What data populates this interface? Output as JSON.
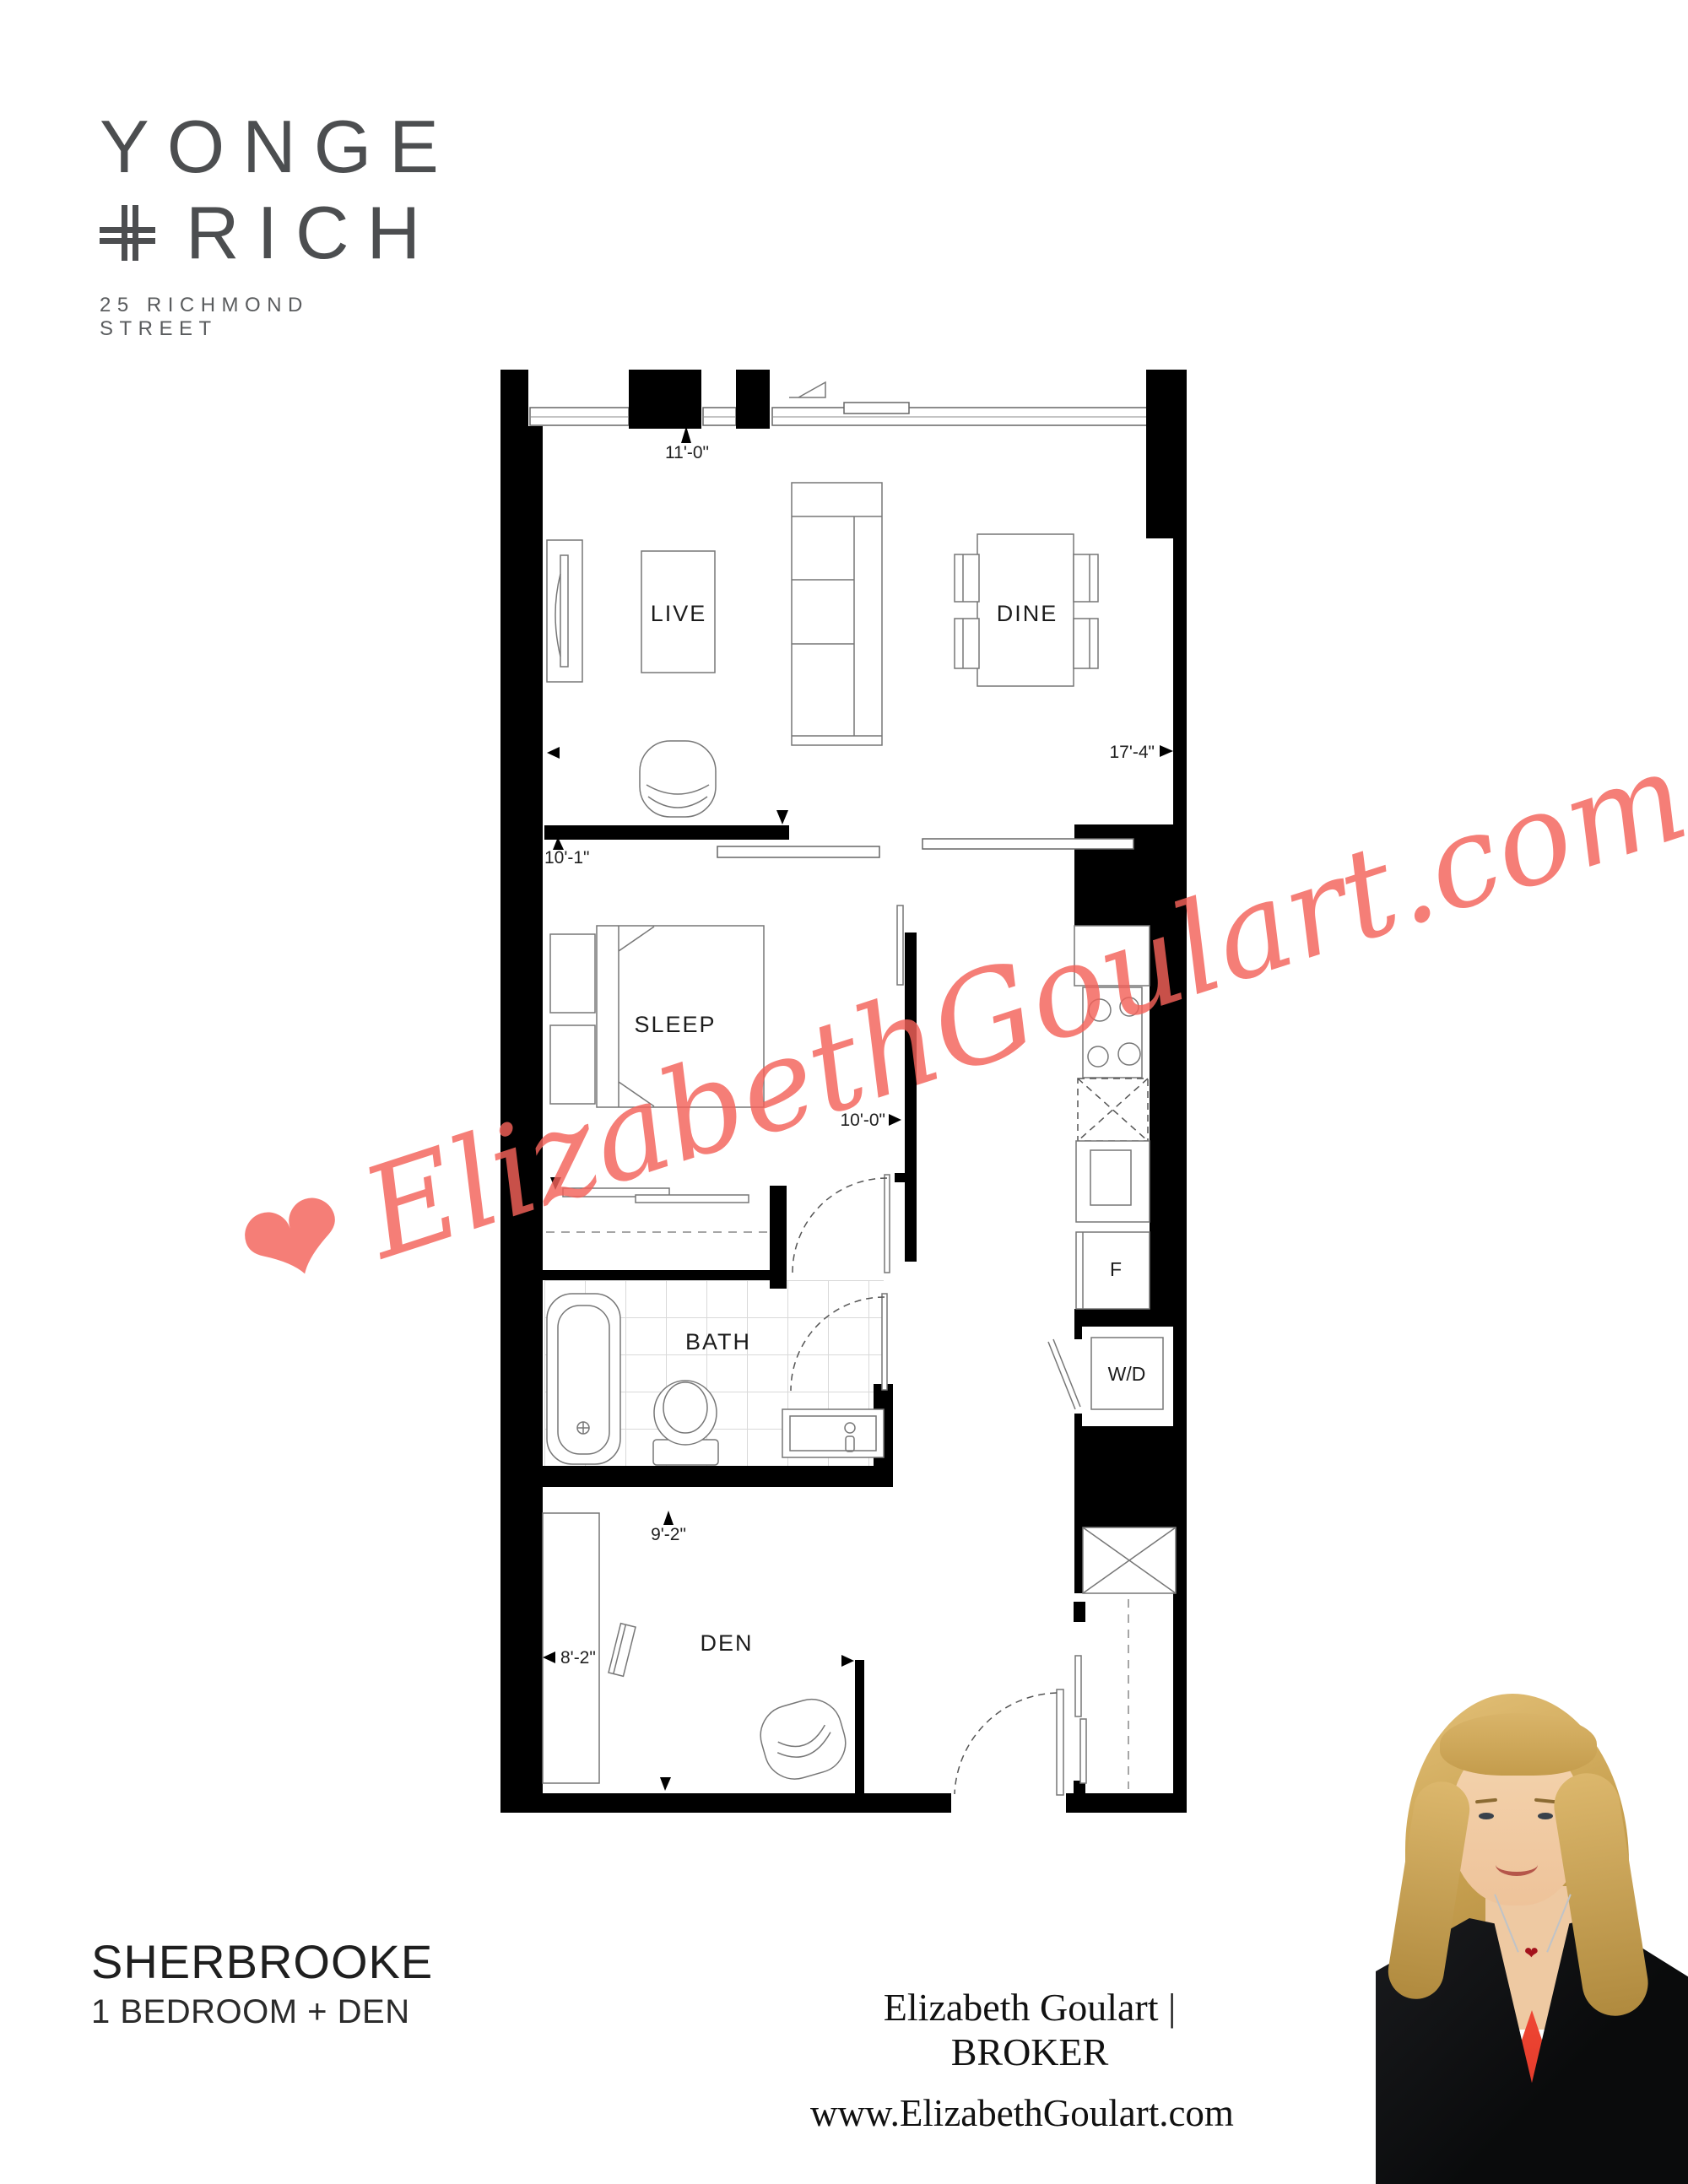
{
  "logo": {
    "name_line1": "YONGE",
    "name_line2": "RICH",
    "plus_icon": "double-plus-icon",
    "address": "25 RICHMOND STREET",
    "color": "#4c4e50"
  },
  "watermark": {
    "heart_icon": "❤",
    "text": "ElizabethGoulart.com",
    "color": "#f4625a"
  },
  "plan": {
    "labels": {
      "live": "LIVE",
      "dine": "DINE",
      "sleep": "SLEEP",
      "bath": "BATH",
      "den": "DEN",
      "washer_dryer": "W/D",
      "fridge": "F"
    },
    "dims": {
      "live_width": "11'-0\"",
      "live_length": "17'-4\"",
      "sleep_width": "10'-1\"",
      "sleep_length": "10'-0\"",
      "den_depth": "9'-2\"",
      "den_width": "8'-2\""
    }
  },
  "footer": {
    "plan_name": "SHERBROOKE",
    "plan_type": "1 BEDROOM + DEN",
    "agent": "Elizabeth Goulart | BROKER",
    "website": "www.ElizabethGoulart.com"
  },
  "colors": {
    "walls": "#000000",
    "accent_red": "#f4625a",
    "logo_gray": "#4c4e50"
  }
}
